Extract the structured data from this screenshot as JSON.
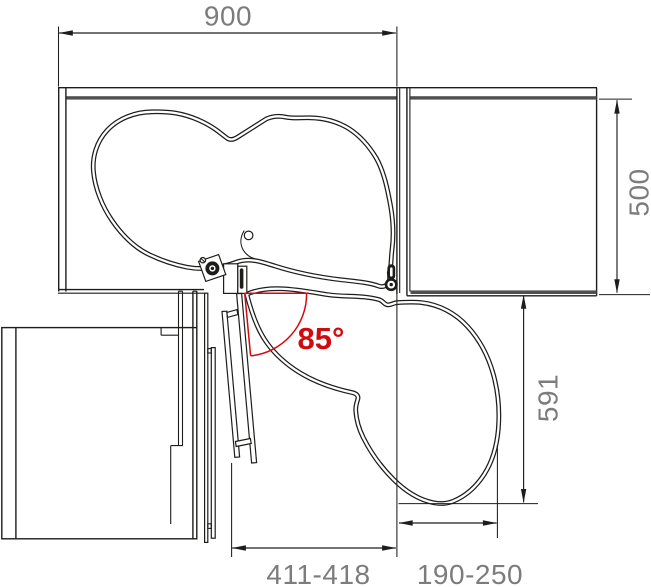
{
  "drawing": {
    "dimensions": {
      "top_width": "900",
      "right_depth": "500",
      "pullout_extent": "591",
      "bottom_left_range": "411-418",
      "bottom_right_range": "190-250"
    },
    "angle": "85°"
  },
  "colors": {
    "line": "#1d1d1b",
    "dim_text": "#7c7c7c",
    "accent_red": "#d10a10",
    "panel_dark": "#4f4f4f",
    "background": "#ffffff"
  }
}
